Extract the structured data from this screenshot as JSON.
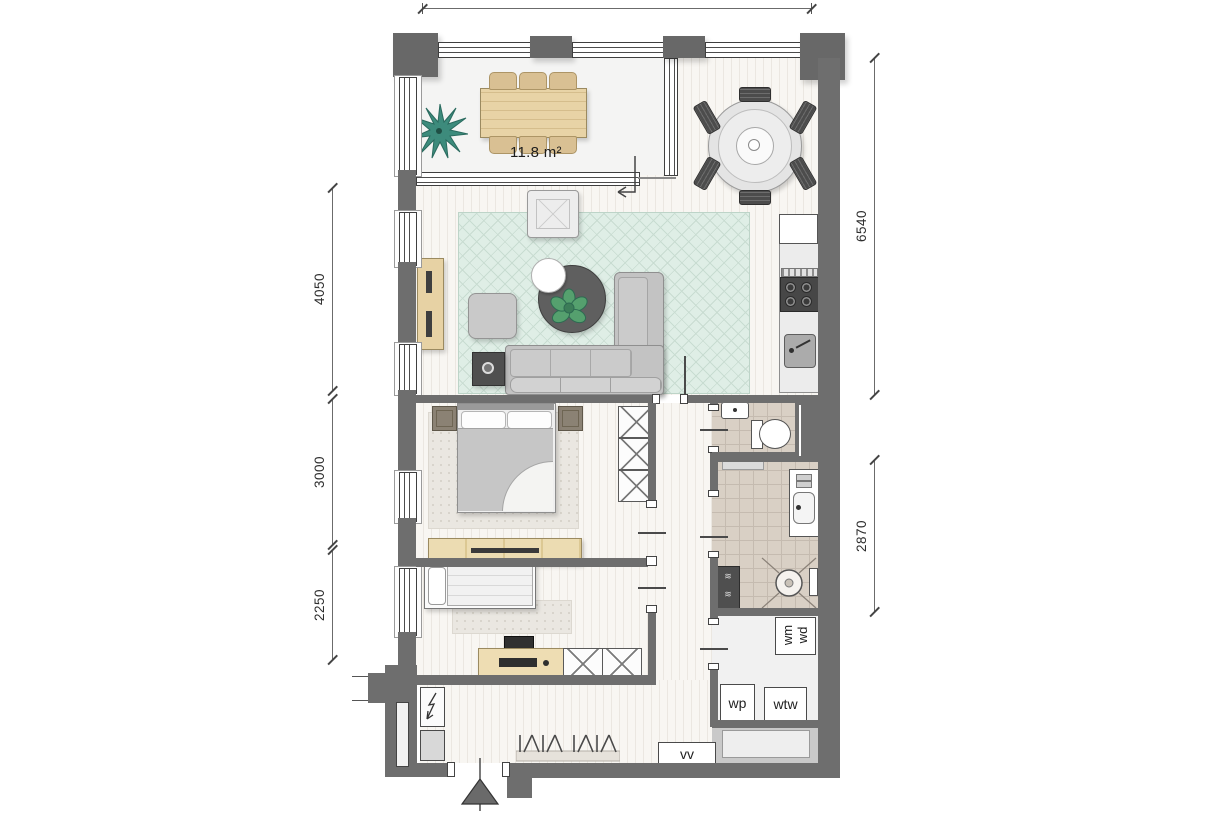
{
  "plan": {
    "type": "apartment-floor-plan",
    "dimensions_left": [
      "4050",
      "3000",
      "2250"
    ],
    "dimensions_right": [
      "6540",
      "2870"
    ],
    "balcony": {
      "area_label": "11.8 m²"
    },
    "utility": {
      "washer": "wm",
      "dryer": "wd",
      "heat_pump": "wp",
      "heat_recovery_unit": "wtw"
    },
    "hallway": {
      "meter_cupboard": "vv"
    },
    "colors": {
      "wall": "#6e6e6e",
      "rug": "#dfeee6",
      "wood": "#e7d2a4",
      "plant": "#3d8b7c",
      "bathroom_tile": "#d9d0c5"
    }
  }
}
